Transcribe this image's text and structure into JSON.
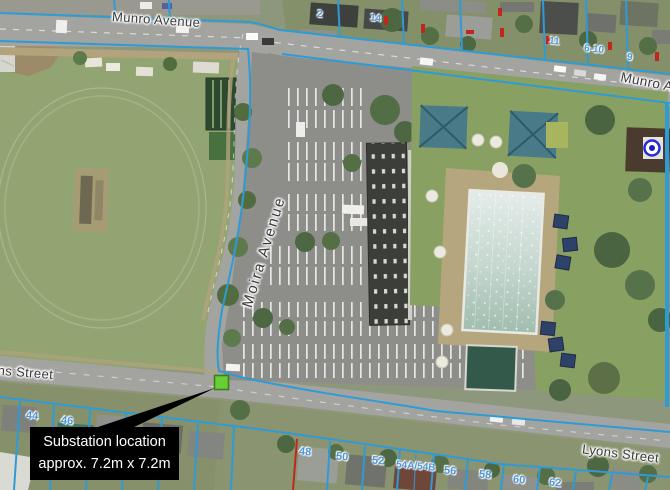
{
  "streets": {
    "munro_top": "Munro Avenue",
    "munro_right": "Munro Avenue",
    "moira": "Moira Avenue",
    "lyons_left": "Lyons Street",
    "lyons_right": "Lyons Street"
  },
  "callout": {
    "line1": "Substation location",
    "line2": "approx. 7.2m x 7.2m"
  },
  "marker": {
    "label": "substation-site",
    "color": "#67cf35"
  },
  "survey_marker": {
    "color": "#2b2bd4"
  },
  "parcels_bottom": [
    "44",
    "46",
    "48",
    "50",
    "52",
    "54A/54B",
    "56",
    "58",
    "60",
    "62"
  ],
  "parcels_top": [
    "2",
    "14",
    "11",
    "6-10",
    "9"
  ],
  "colors": {
    "cadastral_line": "#2e9bd6",
    "parcel_number_text": "#4e94d8",
    "street_label_text": "#3a3a3a",
    "callout_background": "#000000",
    "callout_text": "#ffffff"
  }
}
